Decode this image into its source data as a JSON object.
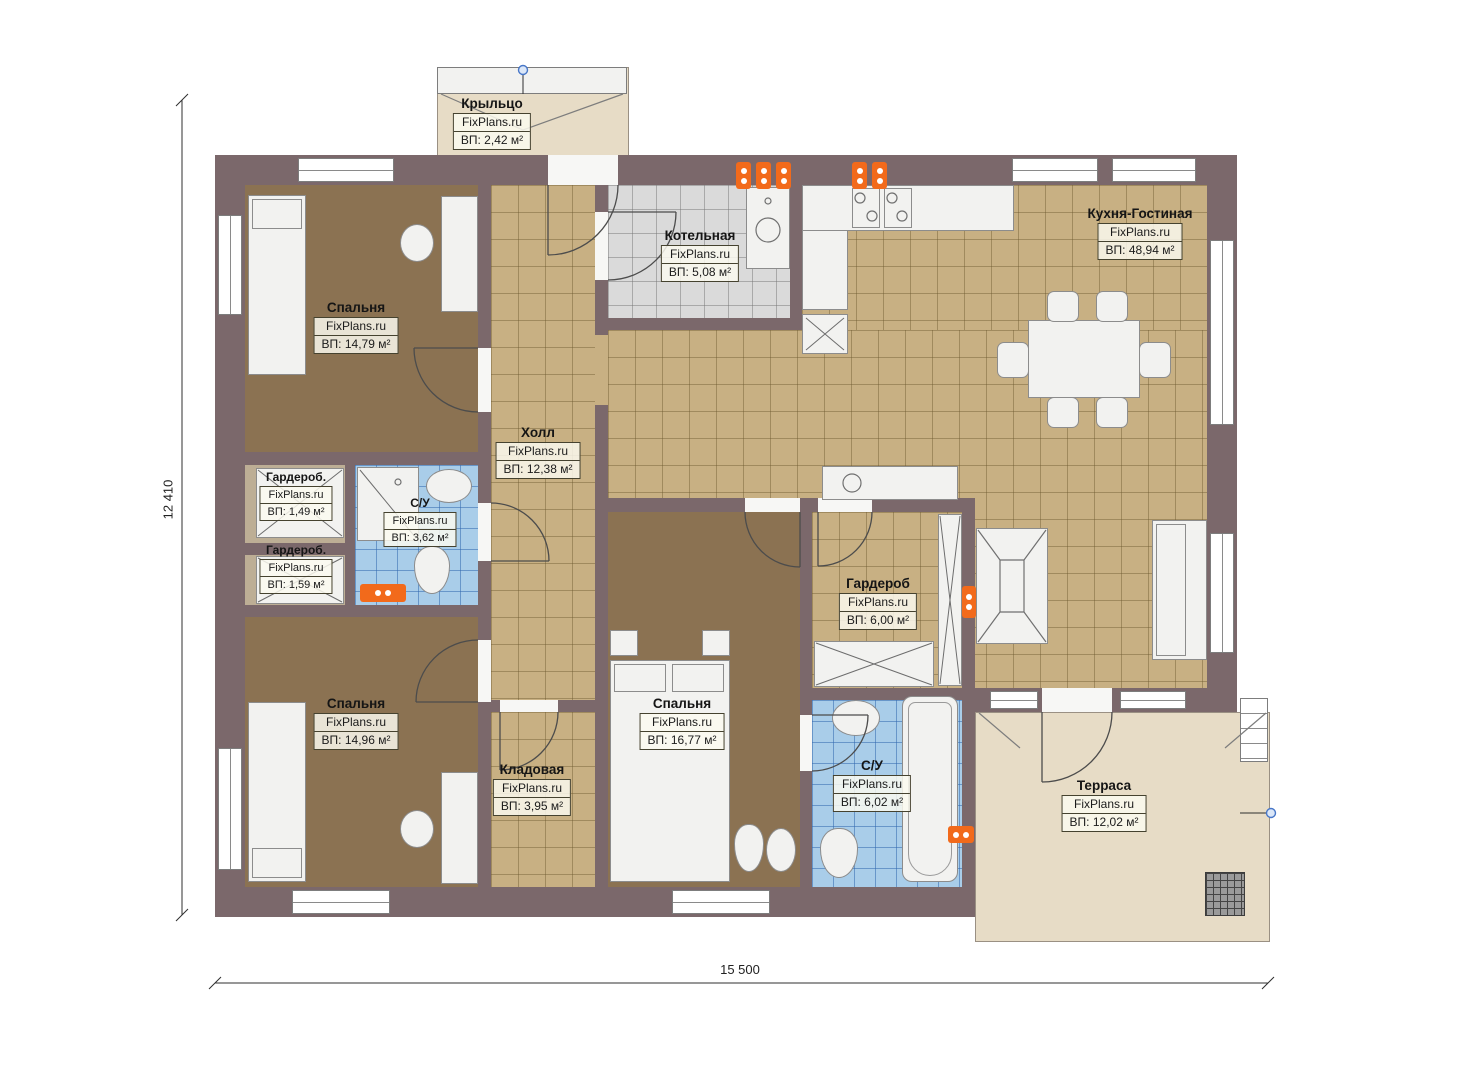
{
  "watermark": "FixPlans.ru",
  "dimension_labels": {
    "bottom": "15 500",
    "left": "12 410"
  },
  "rooms": [
    {
      "name": "Крыльцо",
      "area": "ВП: 2,42 м²"
    },
    {
      "name": "Спальня",
      "area": "ВП: 14,79 м²"
    },
    {
      "name": "Котельная",
      "area": "ВП: 5,08 м²"
    },
    {
      "name": "Кухня-Гостиная",
      "area": "ВП: 48,94 м²"
    },
    {
      "name": "Холл",
      "area": "ВП: 12,38 м²"
    },
    {
      "name": "Гардероб.",
      "area": "ВП: 1,49 м²"
    },
    {
      "name": "Гардероб.",
      "area": "ВП: 1,59 м²"
    },
    {
      "name": "С/У",
      "area": "ВП: 3,62 м²"
    },
    {
      "name": "Спальня",
      "area": "ВП: 14,96 м²"
    },
    {
      "name": "Гардероб",
      "area": "ВП: 6,00 м²"
    },
    {
      "name": "Спальня",
      "area": "ВП: 16,77 м²"
    },
    {
      "name": "Кладовая",
      "area": "ВП: 3,95 м²"
    },
    {
      "name": "С/У",
      "area": "ВП: 6,02 м²"
    },
    {
      "name": "Терраса",
      "area": "ВП: 12,02 м²"
    }
  ],
  "colors": {
    "wall": "#7b686b",
    "floor_bedroom": "#8b7252",
    "floor_tile_tan": "#c8b083",
    "floor_tile_gray": "#dadada",
    "floor_tile_blue": "#a9cde9",
    "outdoor": "#e7dcc6",
    "radiator": "#f26a1b",
    "marker": "#4877c8"
  }
}
